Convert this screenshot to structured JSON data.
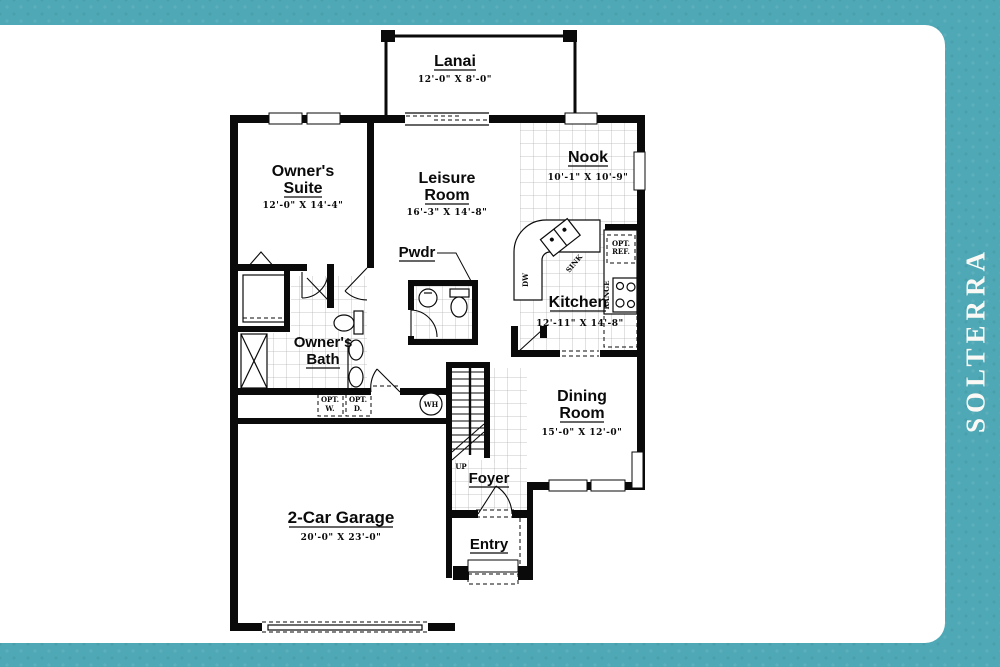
{
  "brand": {
    "name": "SOLTERRA"
  },
  "plan": {
    "lanai": {
      "name": "Lanai",
      "dims": "12'-0\" X 8'-0\""
    },
    "owners_suite": {
      "name1": "Owner's",
      "name2": "Suite",
      "dims": "12'-0\" X 14'-4\""
    },
    "leisure_room": {
      "name1": "Leisure",
      "name2": "Room",
      "dims": "16'-3\" X 14'-8\""
    },
    "nook": {
      "name": "Nook",
      "dims": "10'-1\" X 10'-9\""
    },
    "powder": {
      "name": "Pwdr"
    },
    "kitchen": {
      "name": "Kitchen",
      "dims": "12'-11\" X 14'-8\""
    },
    "owners_bath": {
      "name1": "Owner's",
      "name2": "Bath"
    },
    "dining_room": {
      "name1": "Dining",
      "name2": "Room",
      "dims": "15'-0\" X 12'-0\""
    },
    "foyer": {
      "name": "Foyer"
    },
    "entry": {
      "name": "Entry"
    },
    "garage": {
      "name": "2-Car Garage",
      "dims": "20'-0\" X 23'-0\""
    },
    "stairs": {
      "label": "UP"
    },
    "water_heater": {
      "label": "WH"
    },
    "opt_washer": {
      "line1": "OPT.",
      "line2": "W."
    },
    "opt_dryer": {
      "line1": "OPT.",
      "line2": "D."
    },
    "opt_fridge": {
      "line1": "OPT.",
      "line2": "REF."
    },
    "range": {
      "label": "RANGE"
    },
    "dishwasher": {
      "label": "DW"
    },
    "sink": {
      "label": "SINK"
    }
  }
}
